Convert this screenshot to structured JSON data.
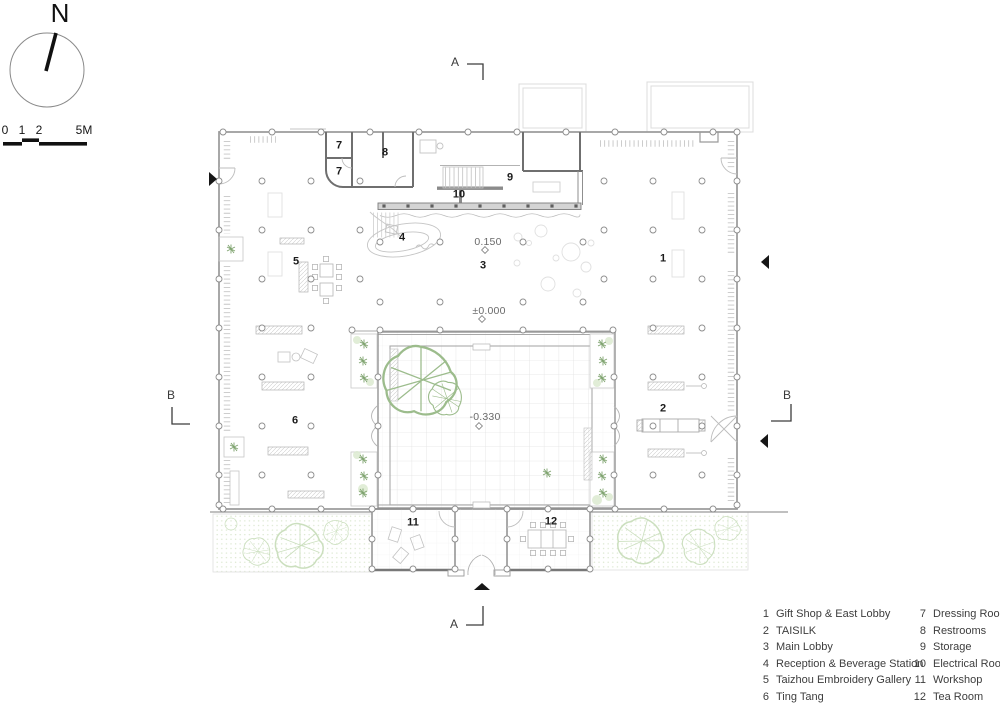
{
  "compass": {
    "label": "N"
  },
  "scale_bar": {
    "labels": [
      "0",
      "1",
      "2",
      "5M"
    ]
  },
  "section_markers": {
    "a_top": "A",
    "a_bottom": "A",
    "b_left": "B",
    "b_right": "B"
  },
  "elevations": [
    {
      "id": "lobby",
      "value": "0.150"
    },
    {
      "id": "ground",
      "value": "±0.000"
    },
    {
      "id": "courtyard",
      "value": "-0.330"
    }
  ],
  "room_labels": [
    {
      "num": "1"
    },
    {
      "num": "2"
    },
    {
      "num": "3"
    },
    {
      "num": "4"
    },
    {
      "num": "5"
    },
    {
      "num": "6"
    },
    {
      "num": "7"
    },
    {
      "num": "7"
    },
    {
      "num": "8"
    },
    {
      "num": "9"
    },
    {
      "num": "10"
    },
    {
      "num": "11"
    },
    {
      "num": "12"
    }
  ],
  "legend": {
    "items": [
      {
        "num": "1",
        "label": "Gift Shop & East Lobby"
      },
      {
        "num": "2",
        "label": "TAISILK"
      },
      {
        "num": "3",
        "label": "Main Lobby"
      },
      {
        "num": "4",
        "label": "Reception & Beverage Station"
      },
      {
        "num": "5",
        "label": "Taizhou Embroidery Gallery"
      },
      {
        "num": "6",
        "label": "Ting Tang"
      },
      {
        "num": "7",
        "label": "Dressing Rooms"
      },
      {
        "num": "8",
        "label": "Restrooms"
      },
      {
        "num": "9",
        "label": "Storage"
      },
      {
        "num": "10",
        "label": "Electrical Room"
      },
      {
        "num": "11",
        "label": "Workshop"
      },
      {
        "num": "12",
        "label": "Tea Room"
      }
    ]
  },
  "colors": {
    "wall": "#9a9a9a",
    "wall_dark": "#6f6f6f",
    "plan_green": "#9cbc8c",
    "marker": "#161616"
  }
}
